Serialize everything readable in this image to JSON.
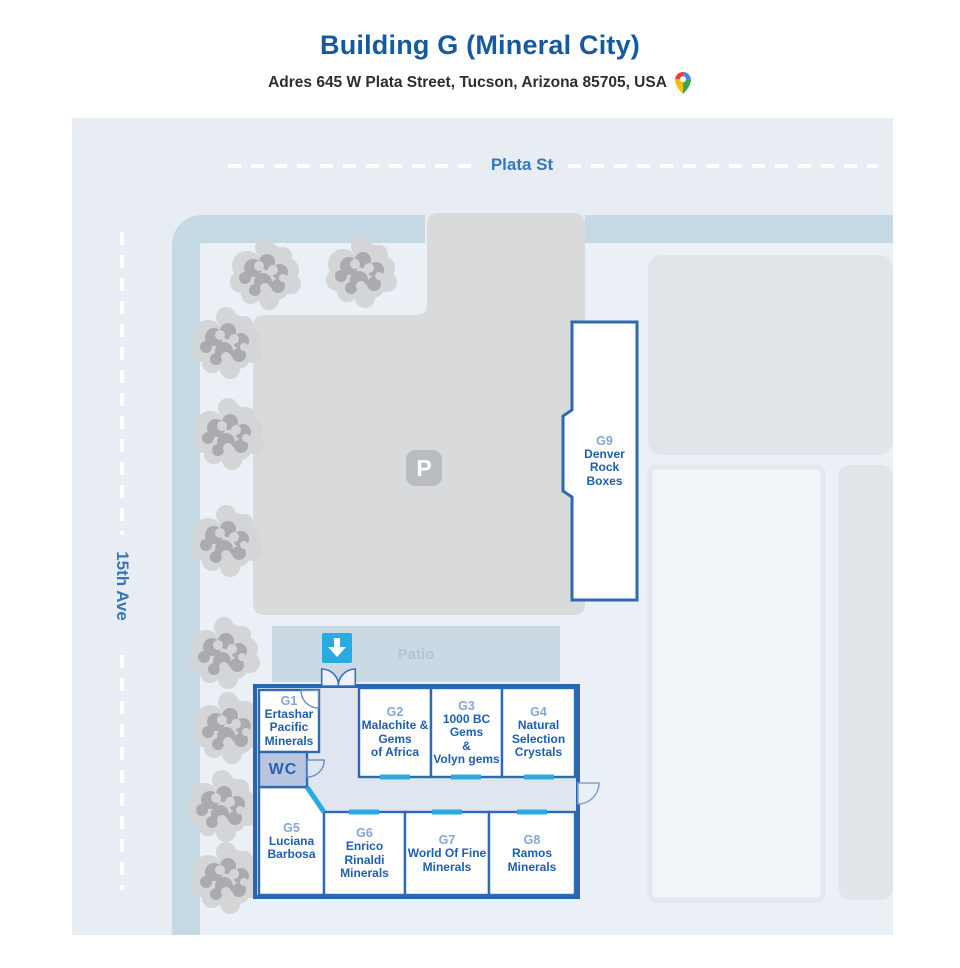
{
  "header": {
    "title": "Building G (Mineral City)",
    "address": "Adres 645 W Plata Street, Tucson, Arizona 85705, USA"
  },
  "map": {
    "streets": {
      "top": "Plata St",
      "left": "15th Ave"
    },
    "areas": {
      "patio": "Patio",
      "parking_marker": "P",
      "wc": "WC"
    },
    "booths": [
      {
        "id": "G1",
        "name": "Ertashar\nPacific\nMinerals"
      },
      {
        "id": "G2",
        "name": "Malachite &\nGems\nof Africa"
      },
      {
        "id": "G3",
        "name": "1000 BC\nGems\n&\nVolyn gems"
      },
      {
        "id": "G4",
        "name": "Natural\nSelection\nCrystals"
      },
      {
        "id": "G5",
        "name": "Luciana\nBarbosa"
      },
      {
        "id": "G6",
        "name": "Enrico\nRinaldi\nMinerals"
      },
      {
        "id": "G7",
        "name": "World Of Fine\nMinerals"
      },
      {
        "id": "G8",
        "name": "Ramos\nMinerals"
      },
      {
        "id": "G9",
        "name": "Denver\nRock\nBoxes"
      }
    ],
    "icons": {
      "entrance_arrow": "down-arrow",
      "map_pin": "google-maps-pin"
    },
    "colors": {
      "title_blue": "#15599f",
      "street_blue": "#3778bc",
      "booth_border_blue": "#2e6ab2",
      "booth_name_blue": "#1e5fae",
      "booth_number_blue": "#86a6d4",
      "entrance_cyan": "#29abe2",
      "road": "#c5d9e4",
      "map_background": "#e8ecf3",
      "parking_gray": "#d8dadc",
      "patio_fill": "#cbd9e5",
      "wc_fill": "#b8c6df"
    }
  }
}
